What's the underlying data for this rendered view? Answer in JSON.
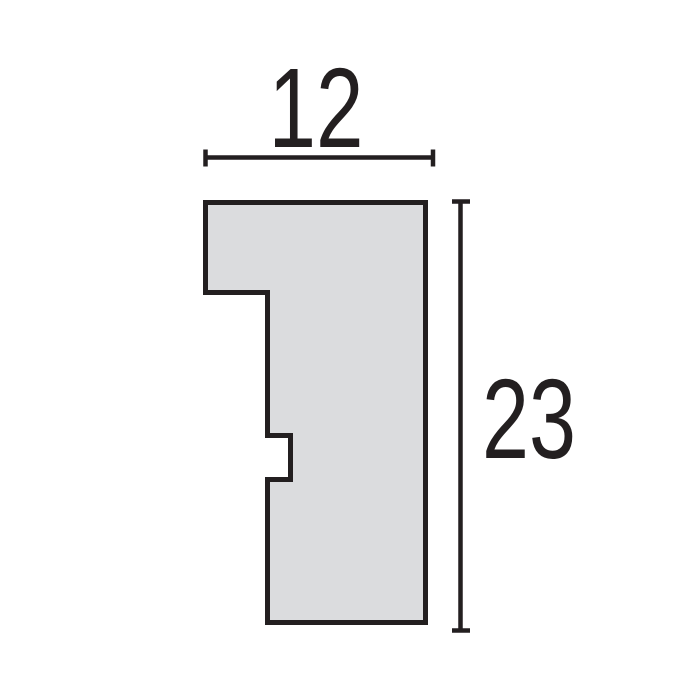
{
  "figure": {
    "title": "Moulding profile cross-section drawing",
    "width_dimension": {
      "label": "12"
    },
    "height_dimension": {
      "label": "23"
    },
    "colors": {
      "line": "#231f20",
      "shape_fill": "#dbdcde",
      "background": "#ffffff",
      "text": "#231f20"
    }
  }
}
